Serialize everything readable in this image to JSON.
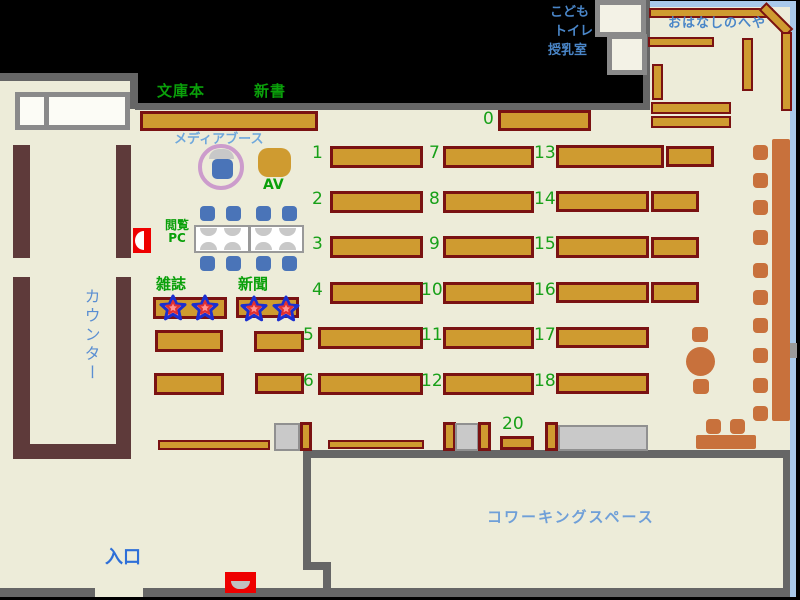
{
  "map_title": "library-floor-map",
  "labels": {
    "bunkobon": "文庫本",
    "shinsho": "新書",
    "media_booth": "メディアブース",
    "av": "AV",
    "viewing": "閲覧",
    "pc": "PC",
    "magazines": "雑誌",
    "newspapers": "新聞",
    "counter": "カウンター",
    "entrance": "入口",
    "kids": "こども",
    "toilet": "トイレ",
    "nursing_room": "授乳室",
    "story_room": "おはなしのへや",
    "coworking": "コワーキングスペース"
  },
  "shelf_numbers": {
    "top": "0",
    "col1": [
      "1",
      "2",
      "3",
      "4",
      "5",
      "6"
    ],
    "col2": [
      "7",
      "8",
      "9",
      "10",
      "11",
      "12"
    ],
    "col3": [
      "13",
      "14",
      "15",
      "16",
      "17",
      "18"
    ],
    "bottom": "20"
  },
  "colors": {
    "floor": "#edecd9",
    "wall_gray": "#666666",
    "wall_lightblue": "#a9c9ea",
    "shelf_fill": "#cf9b30",
    "shelf_border": "#7a1212",
    "counter_brown": "#5e3a3a",
    "seat_sienna": "#c8713c",
    "chair_blue": "#4a74b8",
    "marker_red": "#ee0000",
    "label_green": "#0aa00a",
    "number_green": "#18a018",
    "text_blue": "#3f7cd0",
    "media_text_blue": "#6fa8dc",
    "media_ring_plum": "#cc9ccc"
  }
}
